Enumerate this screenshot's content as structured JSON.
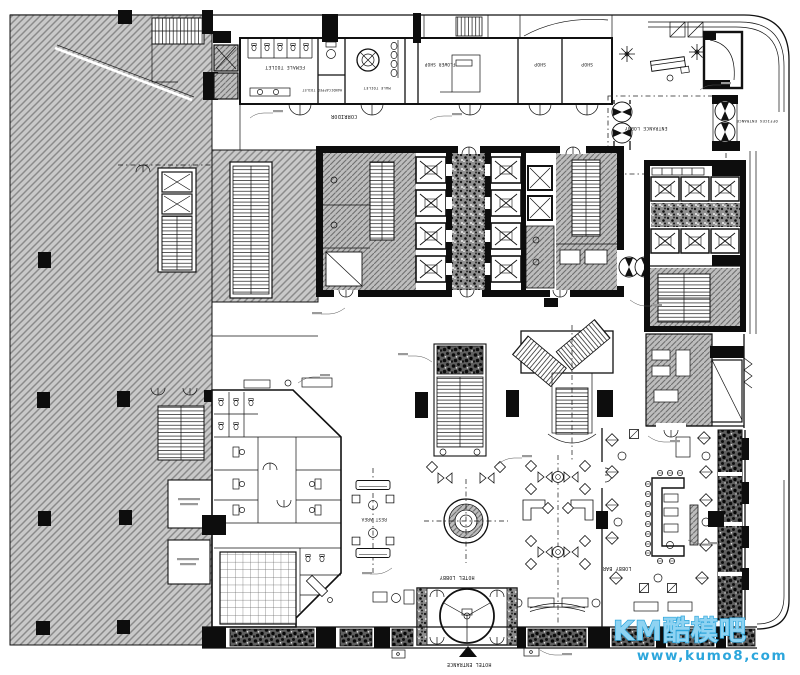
{
  "plan": {
    "labels": {
      "corridor": "CORRIDOR",
      "female_toilet": "FEMALE TOILET",
      "handicapped_toilet": "HANDICAPPED TOILET",
      "male_toilet": "MALE TOILET",
      "flower_shop": "FLOWER SHOP",
      "shop_a": "SHOP",
      "shop_b": "SHOP",
      "entrance_lobby": "ENTRANCE LOBBY",
      "offices_entrance": "OFFICES ENTRANCE",
      "rest_area": "REST AREA",
      "hotel_lobby": "HOTEL LOBBY",
      "lobby_bar": "LOBBY BAR",
      "hotel_entrance": "HOTEL ENTRANCE"
    }
  },
  "watermark": {
    "logo": "KM酷模吧",
    "url": "www,kumo8,com",
    "color": "#2ca6dc"
  },
  "colors": {
    "ink": "#111111",
    "hatch_fill": "#c8c8c8",
    "hatch_line": "#8e8e8e",
    "watermark_blue": "#2ca6dc"
  }
}
